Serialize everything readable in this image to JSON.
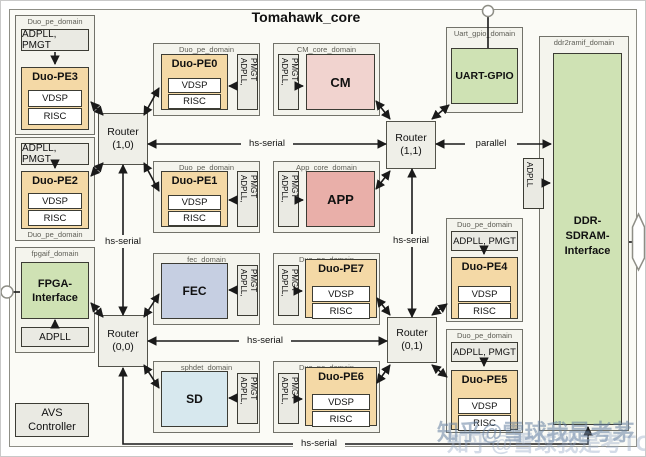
{
  "title": "Tomahawk_core",
  "links": {
    "hs_serial": "hs-serial",
    "parallel": "parallel"
  },
  "routers": {
    "r10": {
      "name": "Router",
      "coord": "(1,0)"
    },
    "r11": {
      "name": "Router",
      "coord": "(1,1)"
    },
    "r00": {
      "name": "Router",
      "coord": "(0,0)"
    },
    "r01": {
      "name": "Router",
      "coord": "(0,1)"
    }
  },
  "pe": {
    "domain_label": "Duo_pe_domain",
    "pmgt": "ADPLL, PMGT",
    "pmgt_line1": "ADPLL,",
    "pmgt_line2": "PMGT",
    "vdsp": "VDSP",
    "risc": "RISC",
    "pe0": "Duo-PE0",
    "pe1": "Duo-PE1",
    "pe2": "Duo-PE2",
    "pe3": "Duo-PE3",
    "pe4": "Duo-PE4",
    "pe5": "Duo-PE5",
    "pe6": "Duo-PE6",
    "pe7": "Duo-PE7"
  },
  "cm": {
    "domain": "CM_core_domain",
    "name": "CM"
  },
  "app": {
    "domain": "App_core_domain",
    "name": "APP"
  },
  "fec": {
    "domain": "fec_domain",
    "name": "FEC"
  },
  "sd": {
    "domain": "sphdet_domain",
    "name": "SD"
  },
  "uart": {
    "domain": "Uart_gpio_domain",
    "name": "UART-GPIO"
  },
  "fpga": {
    "domain": "fpgaif_domain",
    "line1": "FPGA-",
    "line2": "Interface",
    "adpll": "ADPLL"
  },
  "ddr": {
    "domain": "ddr2ramif_domain",
    "line1": "DDR-",
    "line2": "SDRAM-",
    "line3": "Interface",
    "adpll": "ADPLL"
  },
  "avs": {
    "line1": "AVS",
    "line2": "Controller"
  },
  "watermark": {
    "line1": "知乎@雪球我是考茅",
    "line2": "知乎@雪球我是考TOP"
  }
}
